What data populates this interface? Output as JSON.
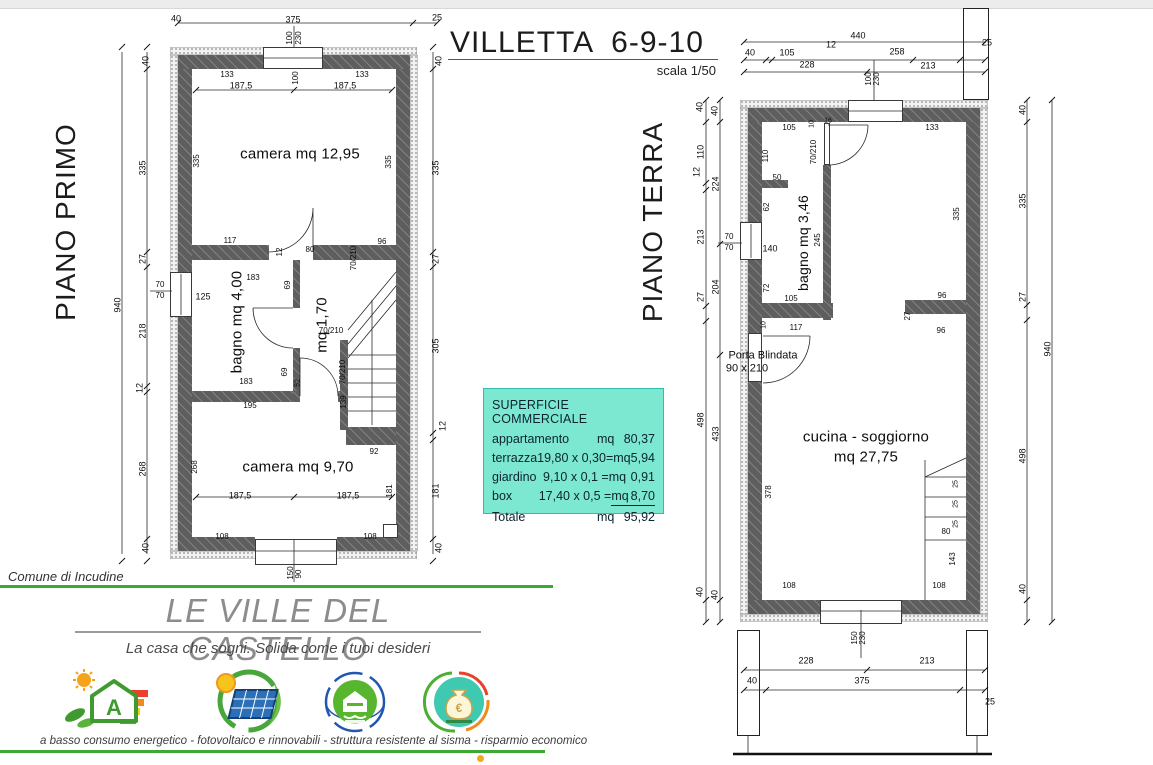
{
  "page": {
    "title": "VILLETTA  6-9-10",
    "scale_note": "scala 1/50",
    "left_plan_title": "PIANO PRIMO",
    "right_plan_title": "PIANO TERRA",
    "comune": "Comune di Incudine",
    "accent_green": "#3aaa35",
    "wall_color": "#5e5e5e"
  },
  "surface_box": {
    "title": "SUPERFICIE COMMERCIALE",
    "bg": "#7de8d2",
    "rows": [
      {
        "label": "appartamento",
        "formula": "",
        "unit": "mq",
        "value": "80,37"
      },
      {
        "label": "terrazza",
        "formula": "19,80 x 0,30=",
        "unit": "mq",
        "value": "5,94"
      },
      {
        "label": "giardino",
        "formula": "9,10 x 0,1 =",
        "unit": "mq",
        "value": "0,91"
      },
      {
        "label": "box",
        "formula": "17,40 x 0,5 =",
        "unit": "mq",
        "value": "8,70"
      },
      {
        "label": "Totale",
        "formula": "",
        "unit": "mq",
        "value": "95,92"
      }
    ]
  },
  "branding": {
    "name": "LE VILLE DEL CASTELLO",
    "tagline": "La casa che sogni. Solida come i tuoi desideri",
    "features_caption": "a basso consumo energetico  -  fotovoltaico e rinnovabili  -  struttura resistente al sisma  -  risparmio economico",
    "badges": [
      "energy-class-a-icon",
      "photovoltaic-icon",
      "seismic-resistant-icon",
      "economic-saving-icon"
    ]
  },
  "left_plan": {
    "labels": [
      {
        "t": "40",
        "x": 176,
        "y": 19
      },
      {
        "t": "375",
        "x": 293,
        "y": 20
      },
      {
        "t": "25",
        "x": 437,
        "y": 18
      },
      {
        "t": "100",
        "x": 290,
        "y": 38,
        "r": -90,
        "s": 8
      },
      {
        "t": "230",
        "x": 299,
        "y": 38,
        "r": -90,
        "s": 8
      },
      {
        "t": "133",
        "x": 227,
        "y": 75,
        "s": 8
      },
      {
        "t": "187,5",
        "x": 241,
        "y": 86
      },
      {
        "t": "100",
        "x": 296,
        "y": 78,
        "r": -90,
        "s": 8
      },
      {
        "t": "187,5",
        "x": 345,
        "y": 86
      },
      {
        "t": "133",
        "x": 362,
        "y": 75,
        "s": 8
      },
      {
        "t": "camera mq 12,95",
        "x": 300,
        "y": 154,
        "s": 15
      },
      {
        "t": "335",
        "x": 197,
        "y": 161,
        "r": -90,
        "s": 8
      },
      {
        "t": "335",
        "x": 389,
        "y": 162,
        "r": -90,
        "s": 8
      },
      {
        "t": "940",
        "x": 118,
        "y": 305,
        "r": -90
      },
      {
        "t": "40",
        "x": 146,
        "y": 61,
        "r": -90
      },
      {
        "t": "335",
        "x": 143,
        "y": 168,
        "r": -90
      },
      {
        "t": "27",
        "x": 143,
        "y": 259,
        "r": -90
      },
      {
        "t": "218",
        "x": 143,
        "y": 331,
        "r": -90
      },
      {
        "t": "12",
        "x": 140,
        "y": 388,
        "r": -90
      },
      {
        "t": "268",
        "x": 143,
        "y": 469,
        "r": -90
      },
      {
        "t": "40",
        "x": 146,
        "y": 548,
        "r": -90
      },
      {
        "t": "40",
        "x": 439,
        "y": 61,
        "r": -90
      },
      {
        "t": "335",
        "x": 436,
        "y": 168,
        "r": -90
      },
      {
        "t": "27",
        "x": 436,
        "y": 259,
        "r": -90
      },
      {
        "t": "305",
        "x": 436,
        "y": 346,
        "r": -90
      },
      {
        "t": "12",
        "x": 443,
        "y": 426,
        "r": -90
      },
      {
        "t": "181",
        "x": 436,
        "y": 491,
        "r": -90
      },
      {
        "t": "40",
        "x": 439,
        "y": 548,
        "r": -90
      },
      {
        "t": "117",
        "x": 230,
        "y": 241,
        "s": 8
      },
      {
        "t": "12",
        "x": 280,
        "y": 252,
        "r": -90,
        "s": 8
      },
      {
        "t": "80",
        "x": 310,
        "y": 250,
        "s": 8
      },
      {
        "t": "70/210",
        "x": 354,
        "y": 258,
        "r": -90,
        "s": 8
      },
      {
        "t": "96",
        "x": 382,
        "y": 242,
        "s": 8
      },
      {
        "t": "183",
        "x": 253,
        "y": 278,
        "s": 8
      },
      {
        "t": "69",
        "x": 288,
        "y": 285,
        "r": -90,
        "s": 8
      },
      {
        "t": "70",
        "x": 160,
        "y": 285,
        "s": 8
      },
      {
        "t": "70",
        "x": 160,
        "y": 296,
        "s": 8
      },
      {
        "t": "125",
        "x": 203,
        "y": 297
      },
      {
        "t": "bagno mq 4,00",
        "x": 237,
        "y": 322,
        "r": -90,
        "s": 15
      },
      {
        "t": "mq 1,70",
        "x": 322,
        "y": 325,
        "r": -90,
        "s": 15
      },
      {
        "t": "70/210",
        "x": 331,
        "y": 331,
        "s": 8
      },
      {
        "t": "183",
        "x": 246,
        "y": 382,
        "s": 8
      },
      {
        "t": "69",
        "x": 285,
        "y": 372,
        "r": -90,
        "s": 8
      },
      {
        "t": "52",
        "x": 298,
        "y": 383,
        "r": -90,
        "s": 7
      },
      {
        "t": "70/210",
        "x": 343,
        "y": 372,
        "r": -90,
        "s": 8
      },
      {
        "t": "195",
        "x": 250,
        "y": 406,
        "s": 8
      },
      {
        "t": "139",
        "x": 344,
        "y": 402,
        "r": -90,
        "s": 8
      },
      {
        "t": "92",
        "x": 374,
        "y": 452,
        "s": 8
      },
      {
        "t": "268",
        "x": 195,
        "y": 467,
        "r": -90,
        "s": 8
      },
      {
        "t": "181",
        "x": 390,
        "y": 491,
        "r": -90,
        "s": 8
      },
      {
        "t": "camera mq 9,70",
        "x": 298,
        "y": 467,
        "s": 15
      },
      {
        "t": "187,5",
        "x": 240,
        "y": 496
      },
      {
        "t": "187,5",
        "x": 348,
        "y": 496
      },
      {
        "t": "108",
        "x": 222,
        "y": 537,
        "s": 8
      },
      {
        "t": "108",
        "x": 370,
        "y": 537,
        "s": 8
      },
      {
        "t": "150",
        "x": 291,
        "y": 573,
        "r": -90,
        "s": 8
      },
      {
        "t": "90",
        "x": 299,
        "y": 574,
        "r": -90,
        "s": 8
      }
    ]
  },
  "right_plan": {
    "labels": [
      {
        "t": "440",
        "x": 858,
        "y": 36
      },
      {
        "t": "40",
        "x": 750,
        "y": 53
      },
      {
        "t": "105",
        "x": 787,
        "y": 53
      },
      {
        "t": "12",
        "x": 831,
        "y": 45
      },
      {
        "t": "258",
        "x": 897,
        "y": 52
      },
      {
        "t": "25",
        "x": 987,
        "y": 43
      },
      {
        "t": "228",
        "x": 807,
        "y": 65
      },
      {
        "t": "213",
        "x": 928,
        "y": 66
      },
      {
        "t": "100",
        "x": 869,
        "y": 79,
        "r": -90,
        "s": 8
      },
      {
        "t": "230",
        "x": 877,
        "y": 79,
        "r": -90,
        "s": 8
      },
      {
        "t": "40",
        "x": 700,
        "y": 107,
        "r": -90
      },
      {
        "t": "40",
        "x": 715,
        "y": 111,
        "r": -90
      },
      {
        "t": "110",
        "x": 701,
        "y": 152,
        "r": -90
      },
      {
        "t": "12",
        "x": 697,
        "y": 172,
        "r": -90
      },
      {
        "t": "224",
        "x": 716,
        "y": 184,
        "r": -90
      },
      {
        "t": "213",
        "x": 701,
        "y": 237,
        "r": -90
      },
      {
        "t": "204",
        "x": 716,
        "y": 287,
        "r": -90
      },
      {
        "t": "27",
        "x": 701,
        "y": 297,
        "r": -90
      },
      {
        "t": "498",
        "x": 701,
        "y": 420,
        "r": -90
      },
      {
        "t": "433",
        "x": 716,
        "y": 434,
        "r": -90
      },
      {
        "t": "40",
        "x": 700,
        "y": 592,
        "r": -90
      },
      {
        "t": "40",
        "x": 715,
        "y": 595,
        "r": -90
      },
      {
        "t": "70",
        "x": 729,
        "y": 237,
        "s": 8
      },
      {
        "t": "70",
        "x": 729,
        "y": 248,
        "s": 8
      },
      {
        "t": "140",
        "x": 770,
        "y": 249
      },
      {
        "t": "40",
        "x": 1023,
        "y": 110,
        "r": -90
      },
      {
        "t": "335",
        "x": 1023,
        "y": 201,
        "r": -90
      },
      {
        "t": "27",
        "x": 1023,
        "y": 297,
        "r": -90
      },
      {
        "t": "498",
        "x": 1023,
        "y": 456,
        "r": -90
      },
      {
        "t": "40",
        "x": 1023,
        "y": 589,
        "r": -90
      },
      {
        "t": "940",
        "x": 1048,
        "y": 349,
        "r": -90
      },
      {
        "t": "105",
        "x": 789,
        "y": 128,
        "s": 8
      },
      {
        "t": "10",
        "x": 812,
        "y": 124,
        "r": -90,
        "s": 7
      },
      {
        "t": "16",
        "x": 828,
        "y": 121,
        "s": 7
      },
      {
        "t": "70/210",
        "x": 814,
        "y": 152,
        "r": -90,
        "s": 8
      },
      {
        "t": "133",
        "x": 932,
        "y": 128,
        "s": 8
      },
      {
        "t": "110",
        "x": 766,
        "y": 156,
        "r": -90,
        "s": 8
      },
      {
        "t": "50",
        "x": 777,
        "y": 178,
        "s": 8
      },
      {
        "t": "62",
        "x": 767,
        "y": 207,
        "r": -90,
        "s": 8
      },
      {
        "t": "bagno mq 3,46",
        "x": 803,
        "y": 243,
        "r": -90,
        "s": 14
      },
      {
        "t": "245",
        "x": 818,
        "y": 240,
        "r": -90,
        "s": 8
      },
      {
        "t": "72",
        "x": 767,
        "y": 288,
        "r": -90,
        "s": 8
      },
      {
        "t": "105",
        "x": 791,
        "y": 299,
        "s": 8
      },
      {
        "t": "335",
        "x": 957,
        "y": 214,
        "r": -90,
        "s": 8
      },
      {
        "t": "96",
        "x": 942,
        "y": 296,
        "s": 8
      },
      {
        "t": "27",
        "x": 908,
        "y": 316,
        "r": -90,
        "s": 8
      },
      {
        "t": "96",
        "x": 941,
        "y": 331,
        "s": 8
      },
      {
        "t": "10",
        "x": 764,
        "y": 325,
        "r": -90,
        "s": 7
      },
      {
        "t": "117",
        "x": 796,
        "y": 328,
        "s": 8
      },
      {
        "t": "Porta Blindata",
        "x": 763,
        "y": 356,
        "s": 11
      },
      {
        "t": "90 x 210",
        "x": 747,
        "y": 369,
        "s": 11
      },
      {
        "t": "cucina - soggiorno",
        "x": 866,
        "y": 437,
        "s": 15
      },
      {
        "t": "mq 27,75",
        "x": 866,
        "y": 457,
        "s": 15
      },
      {
        "t": "378",
        "x": 769,
        "y": 492,
        "r": -90,
        "s": 8
      },
      {
        "t": "25",
        "x": 956,
        "y": 484,
        "r": -90,
        "s": 7
      },
      {
        "t": "25",
        "x": 956,
        "y": 504,
        "r": -90,
        "s": 7
      },
      {
        "t": "25",
        "x": 956,
        "y": 524,
        "r": -90,
        "s": 7
      },
      {
        "t": "80",
        "x": 946,
        "y": 532,
        "s": 8
      },
      {
        "t": "143",
        "x": 953,
        "y": 559,
        "r": -90,
        "s": 8
      },
      {
        "t": "108",
        "x": 789,
        "y": 586,
        "s": 8
      },
      {
        "t": "108",
        "x": 939,
        "y": 586,
        "s": 8
      },
      {
        "t": "150",
        "x": 855,
        "y": 638,
        "r": -90,
        "s": 8
      },
      {
        "t": "230",
        "x": 863,
        "y": 638,
        "r": -90,
        "s": 8
      },
      {
        "t": "228",
        "x": 806,
        "y": 661
      },
      {
        "t": "213",
        "x": 927,
        "y": 661
      },
      {
        "t": "40",
        "x": 752,
        "y": 681
      },
      {
        "t": "375",
        "x": 862,
        "y": 681
      },
      {
        "t": "25",
        "x": 990,
        "y": 702
      }
    ]
  }
}
